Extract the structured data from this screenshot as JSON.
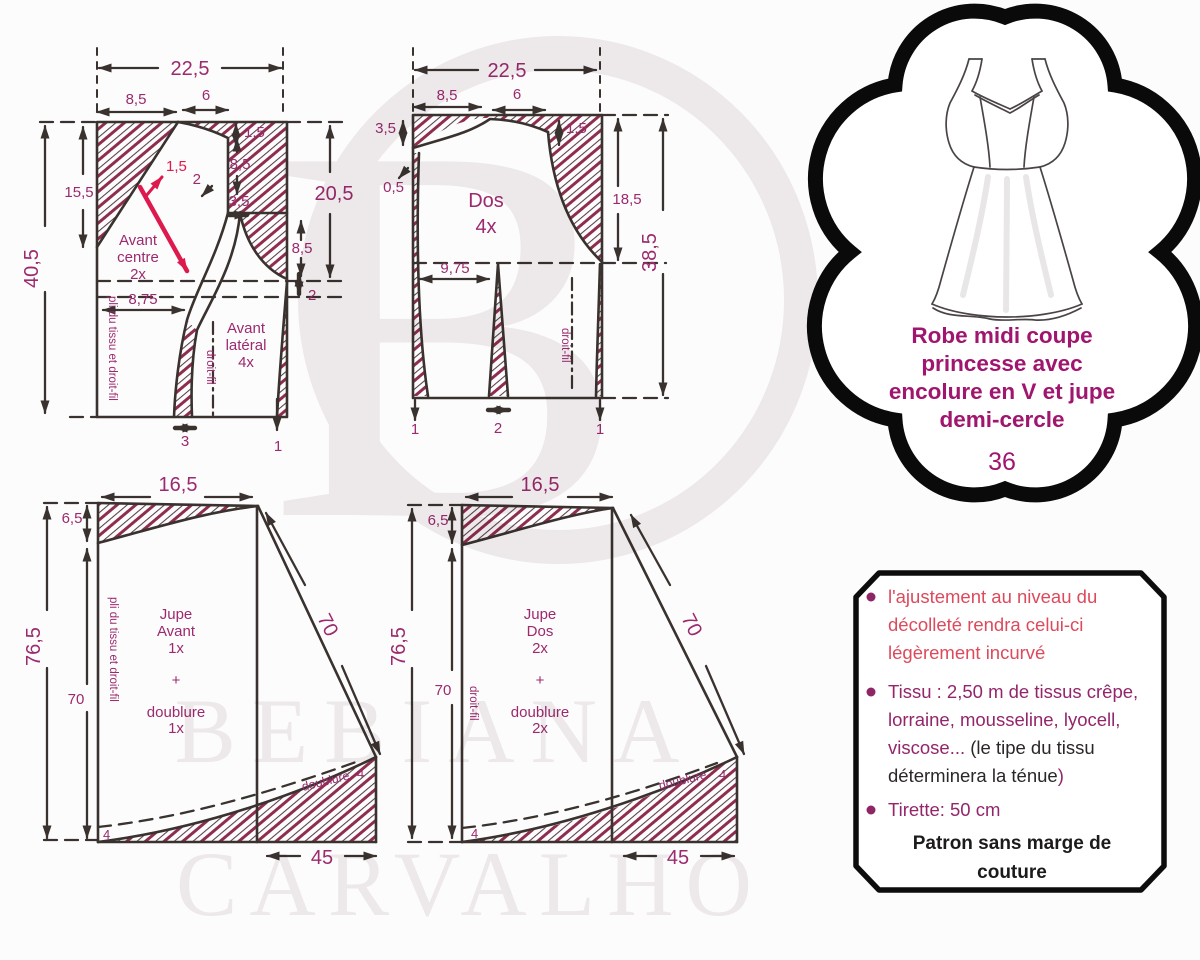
{
  "colors": {
    "magenta_dim": "#9b2a6e",
    "title_magenta": "#a0156e",
    "note_red": "#dc4a5c",
    "grainline_red": "#dd1a4e",
    "hatch_maroon": "#8e2e4f",
    "line_ink": "#39322f",
    "watermark_gray": "#efecee"
  },
  "front_bodice": {
    "panel_center": [
      "Avant",
      "centre",
      "2x"
    ],
    "panel_side": [
      "Avant",
      "latéral",
      "4x"
    ],
    "fold_label": "pli du tissu et droit-fil",
    "grain_label": "droit-fil",
    "grain_sa": "1,5",
    "dims": {
      "total_w": "22,5",
      "neck_w": "8,5",
      "shoulder_w": "6",
      "shoulder_sa": "1,5",
      "front_len": "15,5",
      "total_h": "40,5",
      "right_h": "20,5",
      "armhole_h": "8,5",
      "notch_w": "3,5",
      "seam_note": "2",
      "side_h": "8,5",
      "waist_gap": "2",
      "waist_w": "8,75",
      "dart_w": "3",
      "side_sa": "1"
    }
  },
  "back_bodice": {
    "panel": [
      "Dos",
      "4x"
    ],
    "grain_label": "droit-fil",
    "dims": {
      "total_w": "22,5",
      "neck_w": "8,5",
      "shoulder_w": "6",
      "neck_h": "3,5",
      "shoulder_sa": "1,5",
      "underarm_sa": "0,5",
      "side_h": "18,5",
      "total_h": "38,5",
      "waist_w": "9,75",
      "sa_left": "1",
      "dart_w": "2",
      "sa_right": "1"
    }
  },
  "front_skirt": {
    "label": [
      "Jupe",
      "Avant",
      "1x",
      "+",
      "doublure",
      "1x"
    ],
    "fold_label": "pli du tissu et droit-fil",
    "lining": "doublure",
    "dims": {
      "waist_w": "16,5",
      "facing_h": "6,5",
      "total_h": "76,5",
      "side_h": "70",
      "seam_len": "70",
      "hem_w": "45",
      "hem_sa": "4",
      "hem_sa_left": "4"
    }
  },
  "back_skirt": {
    "label": [
      "Jupe",
      "Dos",
      "2x",
      "+",
      "doublure",
      "2x"
    ],
    "grain_label": "droit-fil",
    "lining": "doublure",
    "dims": {
      "waist_w": "16,5",
      "facing_h": "6,5",
      "total_h": "76,5",
      "side_h": "70",
      "seam_len": "70",
      "hem_w": "45",
      "hem_sa": "4",
      "hem_sa_left": "4"
    }
  },
  "title_card": {
    "lines": [
      "Robe midi coupe",
      "princesse avec",
      "encolure en V et jupe",
      "demi-cercle"
    ],
    "size": "36"
  },
  "notes": {
    "b1": [
      "l'ajustement au niveau du",
      "décolleté rendra celui-ci",
      "légèrement incurvé"
    ],
    "b2_l1": "Tissu : 2,50 m de tissus crêpe,",
    "b2_l2": "lorraine, mousseline, lyocell,",
    "b2_l3a": "viscose... ",
    "b2_l3b": "(le tipe du tissu",
    "b2_l4a": "déterminera la ténue",
    "b2_l4b": ")",
    "b3": "Tirette: 50 cm",
    "footer": [
      "Patron sans marge de",
      "couture"
    ]
  },
  "watermark": {
    "monogram": "B",
    "name_line1": "BEBIANA",
    "name_line2": "CARVALHO"
  }
}
